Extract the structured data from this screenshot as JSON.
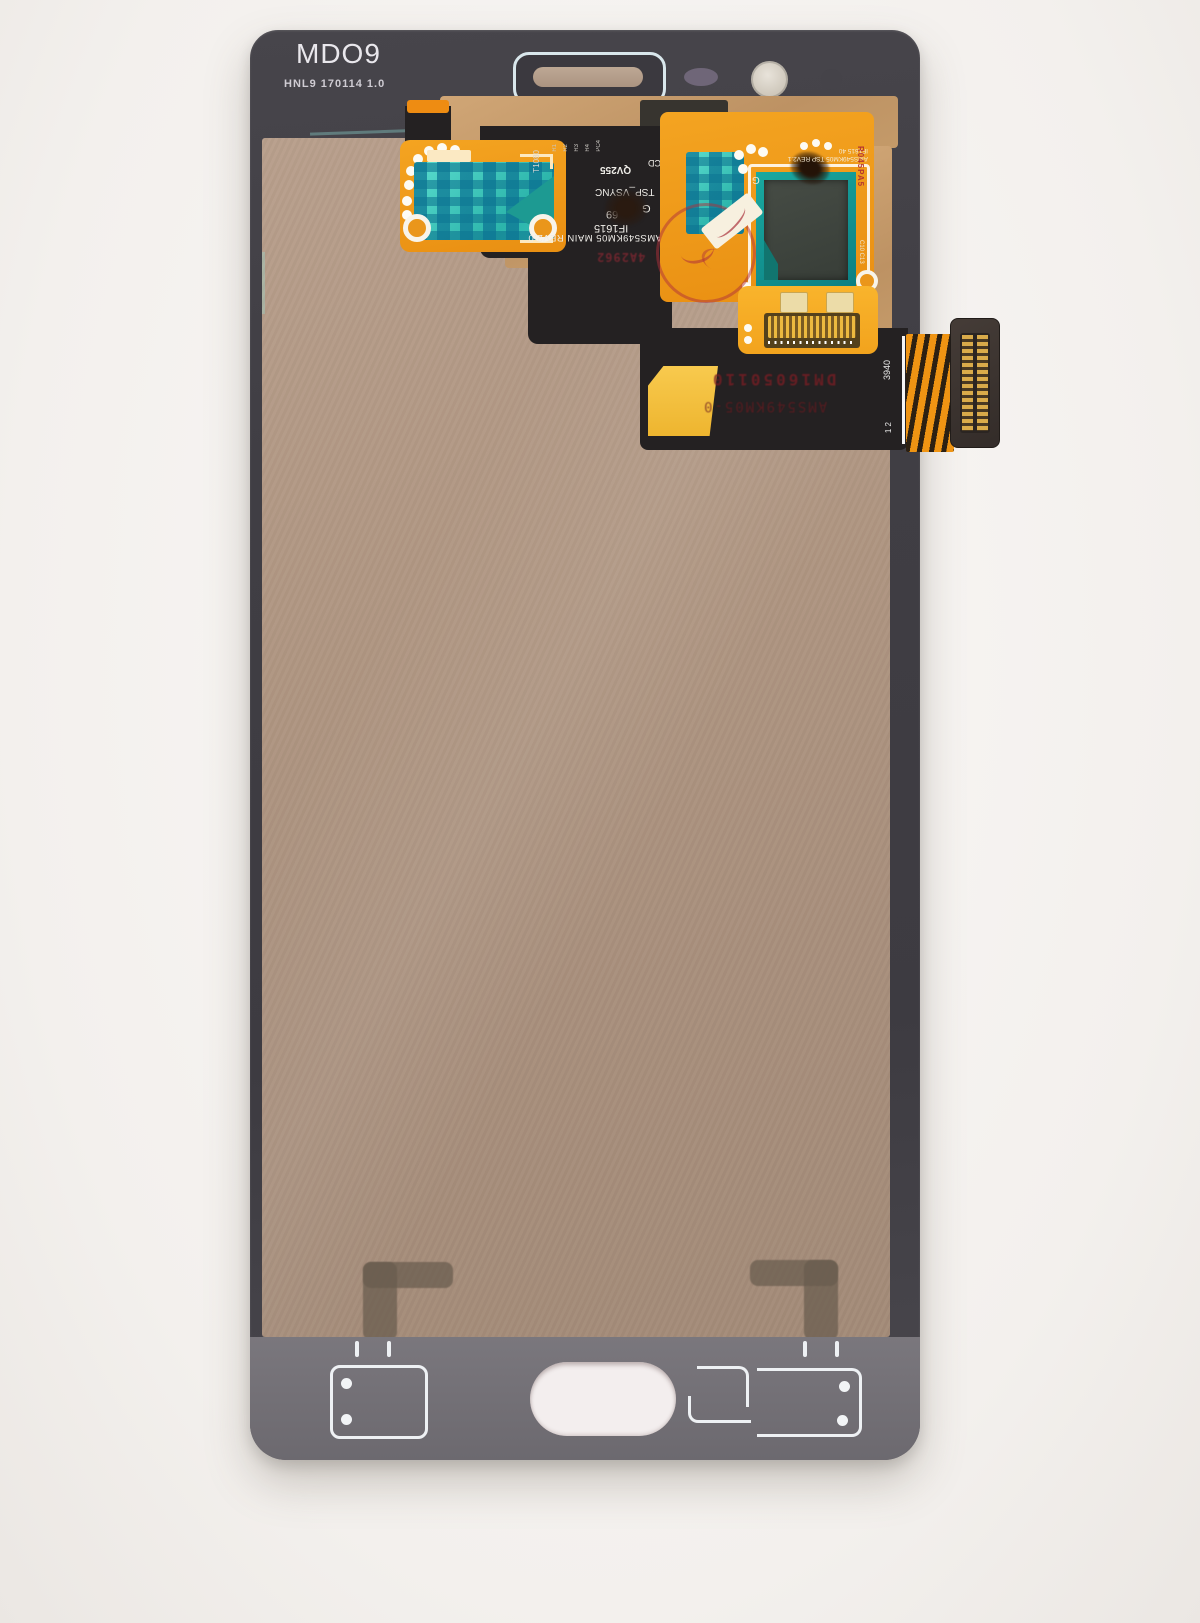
{
  "markings": {
    "model": "MDO9",
    "batch": "HNL9 170114 1.0",
    "main_flex": {
      "board_id": "AMS549KM05 MAIN REV2.0",
      "if_code": "IF1615",
      "lot": "69",
      "grade": "G",
      "signal": "TSP_VSYNC",
      "qv": "QV255",
      "pcd": "PCD",
      "t_code": "T1080",
      "refs": [
        "R1",
        "R2",
        "R3",
        "R4",
        "PC4"
      ],
      "red_code": "4A2962"
    },
    "touch_flex": {
      "board_id": "AMS549KM05 TSP REV2.1",
      "if_code": "IF1615 40",
      "grade": "G",
      "side_code": "R045PA5",
      "cap_refs": "C8 C6 C5 C2 C7",
      "side_refs": "C10 C13"
    },
    "stamps": {
      "serial": "DM16050110",
      "board": "AMS549KM05-0"
    },
    "tail": {
      "num": "3940",
      "pins": "1 2"
    }
  },
  "colors": {
    "copper_film": "#ad947f",
    "bright_copper": "#c79c6b",
    "flex_orange": "#f0991a",
    "tape_teal": "#3cc4b8",
    "stamp_red": "#7c2228",
    "panel_gray": "#413f44",
    "print_white": "#eef1f4"
  }
}
